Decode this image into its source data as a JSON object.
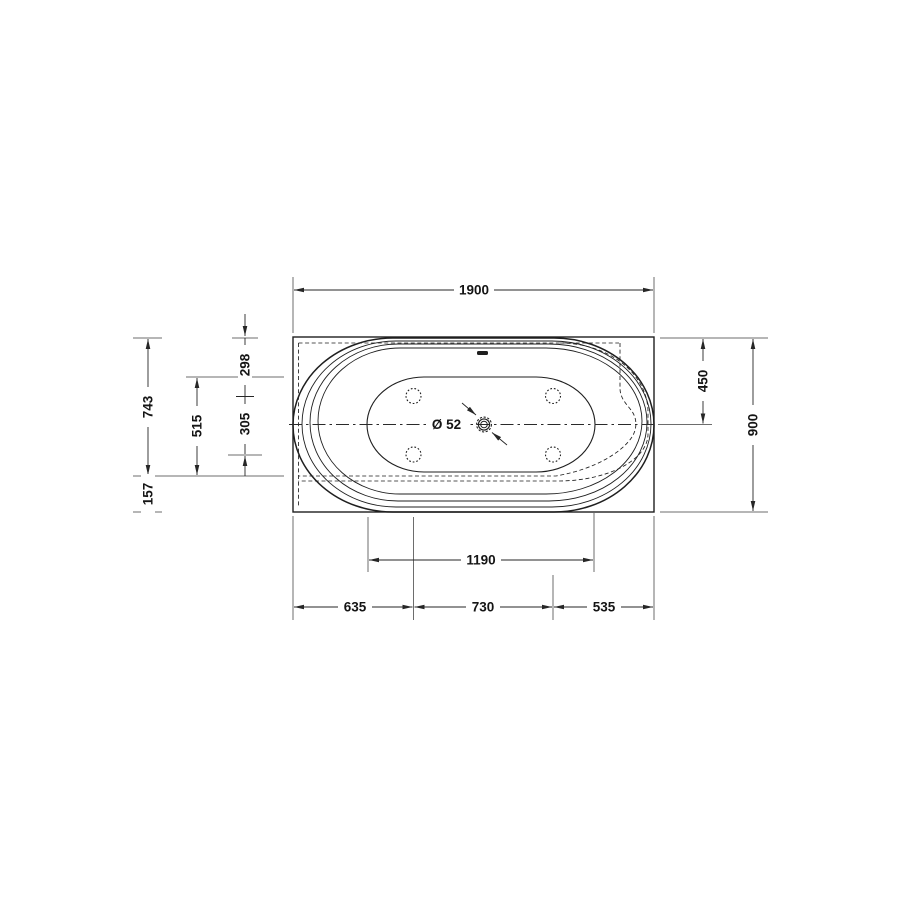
{
  "colors": {
    "ink": "#1f1f1f",
    "background": "#ffffff"
  },
  "dims": {
    "overall_length": "1900",
    "overall_width": "900",
    "back_to_center": "450",
    "back_to_rim_front": "743",
    "rim_front_to_edge": "157",
    "well_width": "515",
    "back_to_jets": "298",
    "jets_row_spacing": "305",
    "well_length": "1190",
    "edge_to_jets_left": "635",
    "jets_to_jets": "730",
    "jets_to_edge_right": "535"
  },
  "drain": {
    "label": "Ø 52"
  }
}
